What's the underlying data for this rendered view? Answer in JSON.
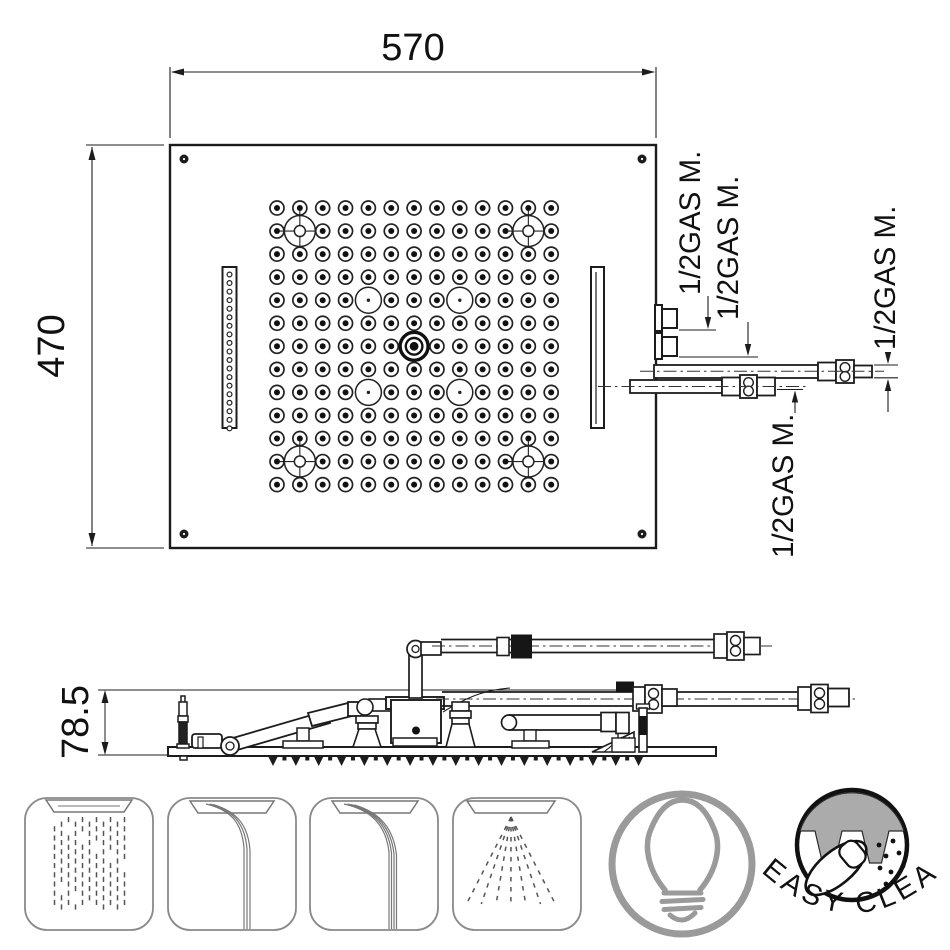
{
  "colors": {
    "line": "#1c1c1c",
    "nozzle": "#111111",
    "gray_fill": "#ababab",
    "bulb_gray": "#9a9a9a",
    "icon_outline": "#8a8a8a",
    "spray_dash": "#555555"
  },
  "top_view": {
    "width_dim": "570",
    "height_dim": "470",
    "connection_labels": {
      "inlet1": "1/2GAS M.",
      "inlet2": "1/2GAS M.",
      "inlet3": "1/2GAS M.",
      "inlet4": "1/2GAS M."
    },
    "grid": {
      "rows": 13,
      "cols": 13,
      "origin": [
        277,
        208
      ],
      "step": [
        22.85,
        23.05
      ],
      "crosshair_positions": [
        [
          2,
          2
        ],
        [
          2,
          12
        ],
        [
          12,
          2
        ],
        [
          12,
          12
        ]
      ],
      "ring_positions": [
        [
          5,
          5
        ],
        [
          5,
          9
        ],
        [
          9,
          5
        ],
        [
          9,
          9
        ]
      ],
      "center_position": [
        7,
        7
      ]
    },
    "left_slot_holes": 19
  },
  "side_view": {
    "height_dim": "78.5",
    "nozzle_teeth": {
      "start": 273,
      "step": 22.85,
      "count": 17
    }
  },
  "icons": {
    "rain": {
      "name": "rain-function",
      "columns": 11,
      "rows": 10
    },
    "cascade_single": {
      "name": "waterfall-single-function"
    },
    "cascade_triple": {
      "name": "waterfall-triple-function"
    },
    "mist": {
      "name": "mist-spray-function",
      "rays": 7
    },
    "light": {
      "name": "light-function"
    },
    "easy_clean": {
      "label": "EASY CLEAN"
    }
  }
}
